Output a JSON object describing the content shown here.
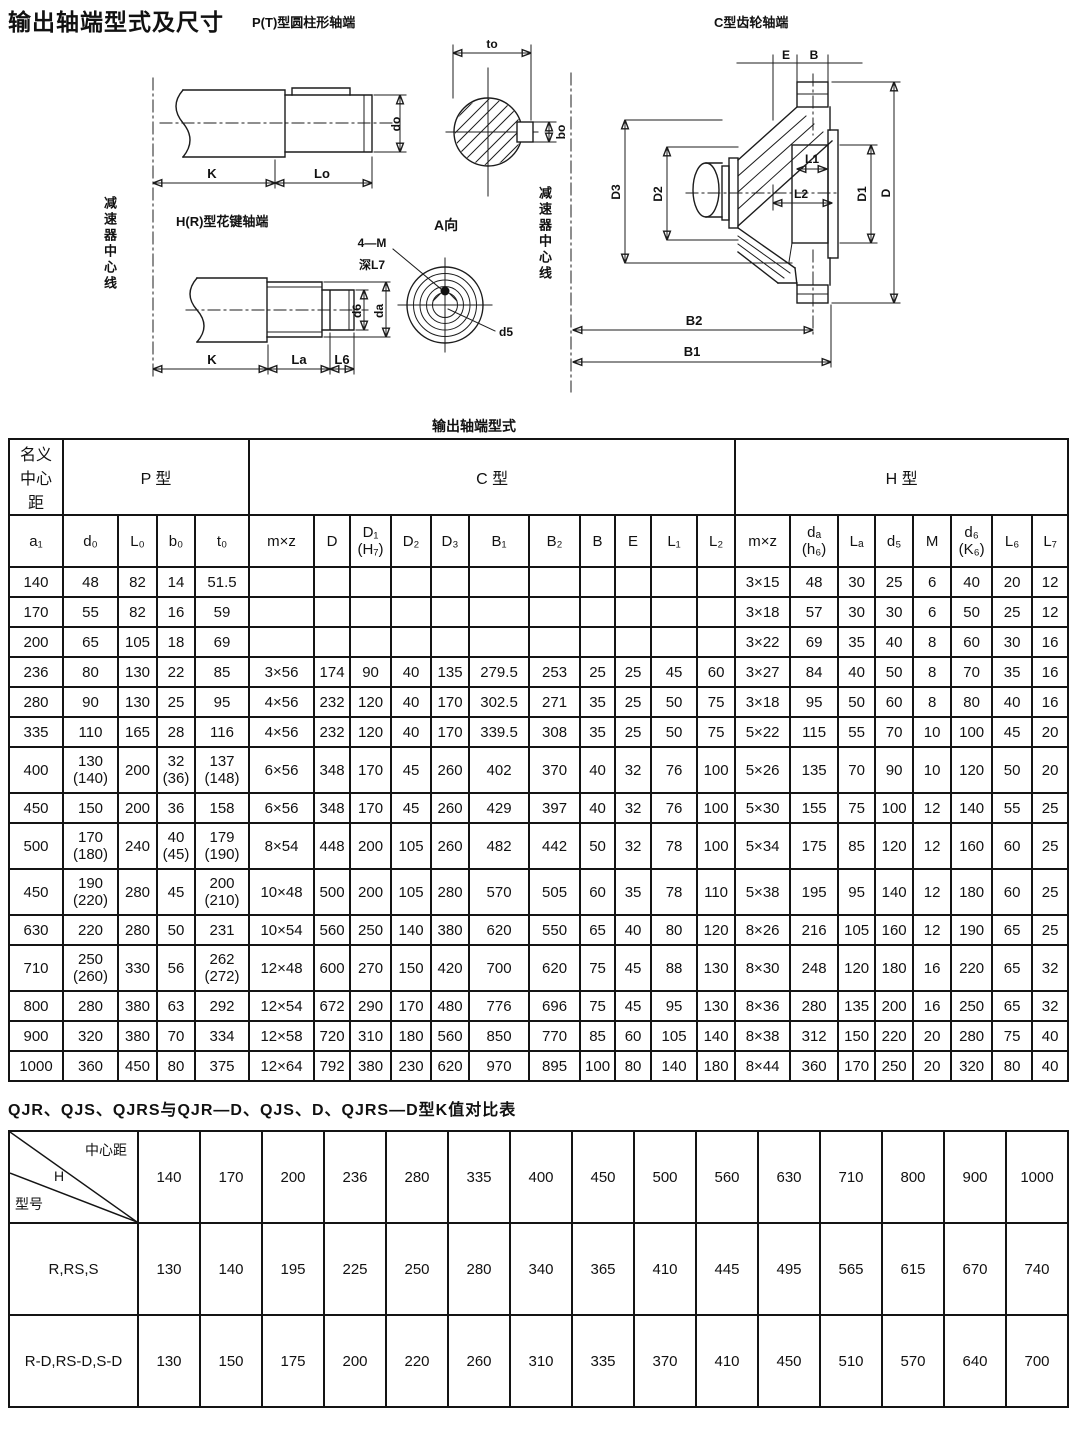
{
  "page": {
    "title": "输出轴端型式及尺寸",
    "ink_color": "#1c1c1c"
  },
  "drawings": {
    "p_label": "P(T)型圆柱形轴端",
    "c_label": "C型齿轮轴端",
    "h_label": "H(R)型花键轴端",
    "a_view": "A向",
    "centerline_left": "减速器中心线",
    "centerline_right": "减速器中心线",
    "dims": {
      "K": "K",
      "Lo": "Lo",
      "do": "do",
      "to": "to",
      "bo": "bo",
      "fourM": "4—M",
      "deep": "深L7",
      "d5": "d5",
      "d6": "d6",
      "da": "da",
      "La": "La",
      "L6": "L6",
      "E": "E",
      "B": "B",
      "D": "D",
      "D1": "D1",
      "D2": "D2",
      "D3": "D3",
      "L1": "L1",
      "L2": "L2",
      "B1": "B1",
      "B2": "B2"
    }
  },
  "table1": {
    "caption": "输出轴端型式",
    "corner": "名义\n中心\n距",
    "corner_sub": "a₁",
    "groups": [
      {
        "label": "P 型",
        "span": 4
      },
      {
        "label": "C 型",
        "span": 11
      },
      {
        "label": "H 型",
        "span": 8
      }
    ],
    "subheaders": [
      "d₀",
      "L₀",
      "b₀",
      "t₀",
      "m×z",
      "D",
      "D₁\n(H₇)",
      "D₂",
      "D₃",
      "B₁",
      "B₂",
      "B",
      "E",
      "L₁",
      "L₂",
      "m×z",
      "dₐ\n(h₆)",
      "Lₐ",
      "d₅",
      "M",
      "d₆\n(K₆)",
      "L₆",
      "L₇"
    ],
    "rows": [
      [
        "140",
        "48",
        "82",
        "14",
        "51.5",
        "",
        "",
        "",
        "",
        "",
        "",
        "",
        "",
        "",
        "",
        "",
        "3×15",
        "48",
        "30",
        "25",
        "6",
        "40",
        "20",
        "12"
      ],
      [
        "170",
        "55",
        "82",
        "16",
        "59",
        "",
        "",
        "",
        "",
        "",
        "",
        "",
        "",
        "",
        "",
        "",
        "3×18",
        "57",
        "30",
        "30",
        "6",
        "50",
        "25",
        "12"
      ],
      [
        "200",
        "65",
        "105",
        "18",
        "69",
        "",
        "",
        "",
        "",
        "",
        "",
        "",
        "",
        "",
        "",
        "",
        "3×22",
        "69",
        "35",
        "40",
        "8",
        "60",
        "30",
        "16"
      ],
      [
        "236",
        "80",
        "130",
        "22",
        "85",
        "3×56",
        "174",
        "90",
        "40",
        "135",
        "279.5",
        "253",
        "25",
        "25",
        "45",
        "60",
        "3×27",
        "84",
        "40",
        "50",
        "8",
        "70",
        "35",
        "16"
      ],
      [
        "280",
        "90",
        "130",
        "25",
        "95",
        "4×56",
        "232",
        "120",
        "40",
        "170",
        "302.5",
        "271",
        "35",
        "25",
        "50",
        "75",
        "3×18",
        "95",
        "50",
        "60",
        "8",
        "80",
        "40",
        "16"
      ],
      [
        "335",
        "110",
        "165",
        "28",
        "116",
        "4×56",
        "232",
        "120",
        "40",
        "170",
        "339.5",
        "308",
        "35",
        "25",
        "50",
        "75",
        "5×22",
        "115",
        "55",
        "70",
        "10",
        "100",
        "45",
        "20"
      ],
      [
        "400",
        "130\n(140)",
        "200",
        "32\n(36)",
        "137\n(148)",
        "6×56",
        "348",
        "170",
        "45",
        "260",
        "402",
        "370",
        "40",
        "32",
        "76",
        "100",
        "5×26",
        "135",
        "70",
        "90",
        "10",
        "120",
        "50",
        "20"
      ],
      [
        "450",
        "150",
        "200",
        "36",
        "158",
        "6×56",
        "348",
        "170",
        "45",
        "260",
        "429",
        "397",
        "40",
        "32",
        "76",
        "100",
        "5×30",
        "155",
        "75",
        "100",
        "12",
        "140",
        "55",
        "25"
      ],
      [
        "500",
        "170\n(180)",
        "240",
        "40\n(45)",
        "179\n(190)",
        "8×54",
        "448",
        "200",
        "105",
        "260",
        "482",
        "442",
        "50",
        "32",
        "78",
        "100",
        "5×34",
        "175",
        "85",
        "120",
        "12",
        "160",
        "60",
        "25"
      ],
      [
        "450",
        "190\n(220)",
        "280",
        "45",
        "200\n(210)",
        "10×48",
        "500",
        "200",
        "105",
        "280",
        "570",
        "505",
        "60",
        "35",
        "78",
        "110",
        "5×38",
        "195",
        "95",
        "140",
        "12",
        "180",
        "60",
        "25"
      ],
      [
        "630",
        "220",
        "280",
        "50",
        "231",
        "10×54",
        "560",
        "250",
        "140",
        "380",
        "620",
        "550",
        "65",
        "40",
        "80",
        "120",
        "8×26",
        "216",
        "105",
        "160",
        "12",
        "190",
        "65",
        "25"
      ],
      [
        "710",
        "250\n(260)",
        "330",
        "56",
        "262\n(272)",
        "12×48",
        "600",
        "270",
        "150",
        "420",
        "700",
        "620",
        "75",
        "45",
        "88",
        "130",
        "8×30",
        "248",
        "120",
        "180",
        "16",
        "220",
        "65",
        "32"
      ],
      [
        "800",
        "280",
        "380",
        "63",
        "292",
        "12×54",
        "672",
        "290",
        "170",
        "480",
        "776",
        "696",
        "75",
        "45",
        "95",
        "130",
        "8×36",
        "280",
        "135",
        "200",
        "16",
        "250",
        "65",
        "32"
      ],
      [
        "900",
        "320",
        "380",
        "70",
        "334",
        "12×58",
        "720",
        "310",
        "180",
        "560",
        "850",
        "770",
        "85",
        "60",
        "105",
        "140",
        "8×38",
        "312",
        "150",
        "220",
        "20",
        "280",
        "75",
        "40"
      ],
      [
        "1000",
        "360",
        "450",
        "80",
        "375",
        "12×64",
        "792",
        "380",
        "230",
        "620",
        "970",
        "895",
        "100",
        "80",
        "140",
        "180",
        "8×44",
        "360",
        "170",
        "250",
        "20",
        "320",
        "80",
        "40"
      ]
    ]
  },
  "table2": {
    "title": "QJR、QJS、QJRS与QJR—D、QJS、D、QJRS—D型K值对比表",
    "corner_top": "中心距",
    "corner_mid": "H",
    "corner_bottom": "型号",
    "columns": [
      "140",
      "170",
      "200",
      "236",
      "280",
      "335",
      "400",
      "450",
      "500",
      "560",
      "630",
      "710",
      "800",
      "900",
      "1000"
    ],
    "rows": [
      {
        "label": "R,RS,S",
        "values": [
          "130",
          "140",
          "195",
          "225",
          "250",
          "280",
          "340",
          "365",
          "410",
          "445",
          "495",
          "565",
          "615",
          "670",
          "740"
        ]
      },
      {
        "label": "R-D,RS-D,S-D",
        "values": [
          "130",
          "150",
          "175",
          "200",
          "220",
          "260",
          "310",
          "335",
          "370",
          "410",
          "450",
          "510",
          "570",
          "640",
          "700"
        ]
      }
    ]
  }
}
